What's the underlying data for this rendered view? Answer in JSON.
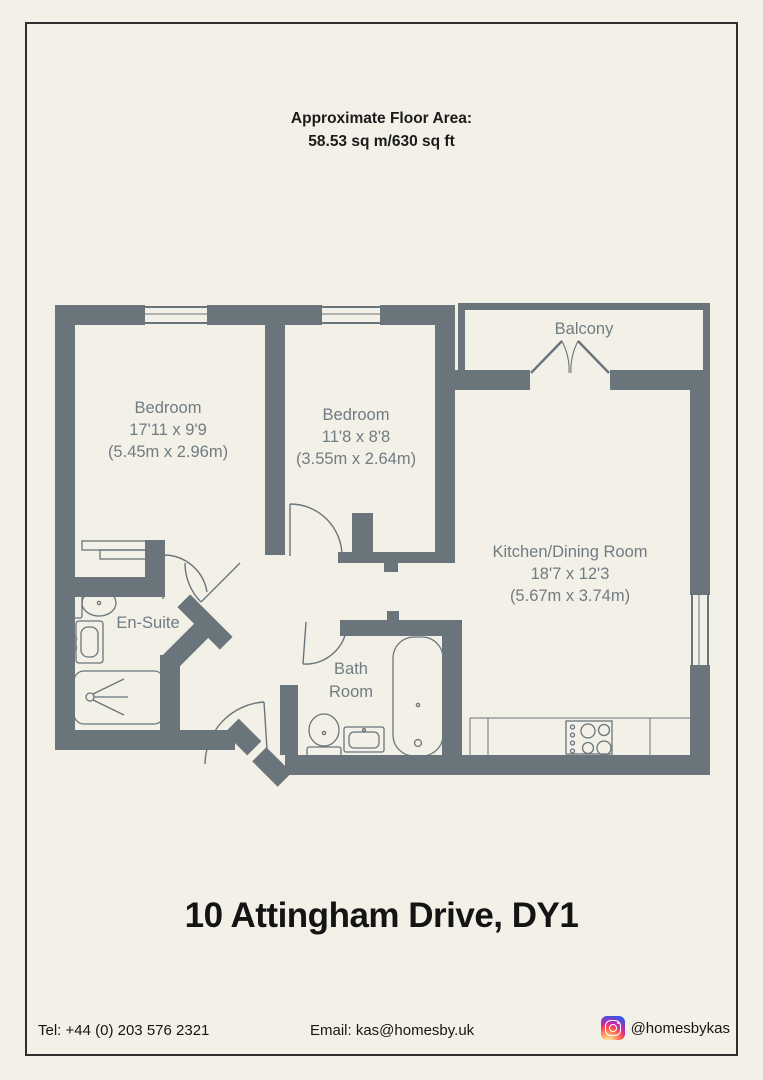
{
  "page": {
    "background_color": "#f2f0e7",
    "border_color": "#2e2e2e"
  },
  "header": {
    "line1": "Approximate Floor Area:",
    "line2": "58.53 sq m/630 sq ft"
  },
  "floorplan": {
    "wall_color": "#6a757b",
    "label_color": "#717c82",
    "rooms": {
      "balcony": {
        "label": "Balcony"
      },
      "bedroom1": {
        "label": "Bedroom",
        "imperial": "17'11 x 9'9",
        "metric": "(5.45m x 2.96m)"
      },
      "bedroom2": {
        "label": "Bedroom",
        "imperial": "11'8 x 8'8",
        "metric": "(3.55m x 2.64m)"
      },
      "kitchen": {
        "label": "Kitchen/Dining Room",
        "imperial": "18'7 x 12'3",
        "metric": "(5.67m x 3.74m)"
      },
      "ensuite": {
        "label": "En-Suite"
      },
      "bathroom": {
        "line1": "Bath",
        "line2": "Room"
      }
    },
    "fixtures": [
      "toilet",
      "sink",
      "shower",
      "bathtub",
      "hob",
      "wardrobe",
      "kitchen-counter"
    ]
  },
  "title": "10 Attingham Drive, DY1",
  "footer": {
    "tel": "Tel: +44 (0) 203 576 2321",
    "email": "Email: kas@homesby.uk",
    "instagram_handle": "@homesbykas",
    "instagram_icon": "instagram-icon"
  }
}
